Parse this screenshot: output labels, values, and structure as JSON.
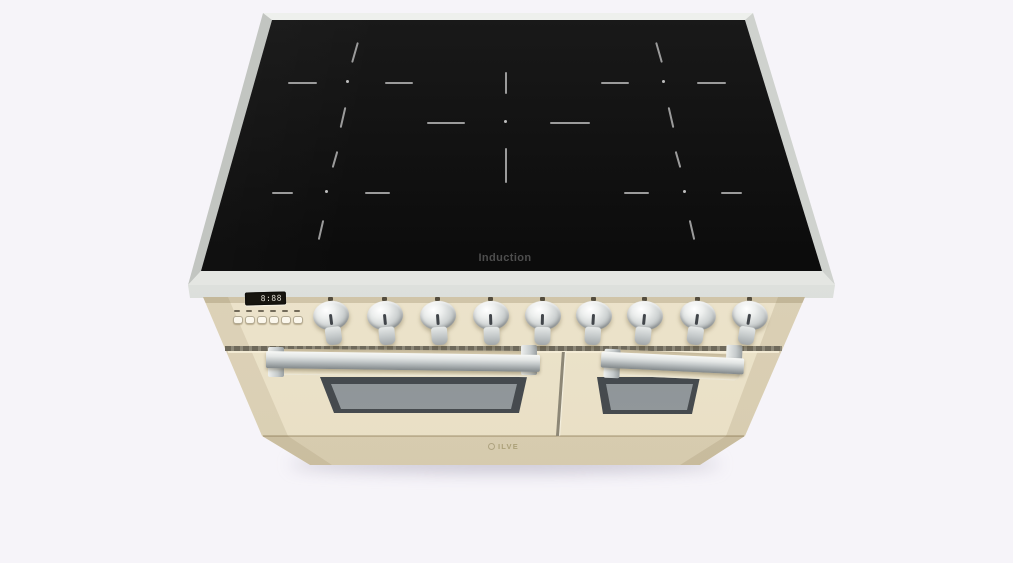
{
  "product": {
    "name": "Freestanding induction range cooker, top front view",
    "brand": "ILVE",
    "colors": {
      "background": "#f6f4f9",
      "body_cream": "#ece3cb",
      "cooktop_glass": "#0e0e0e",
      "stainless_trim": "#d6d9d5",
      "chrome_hardware": "#c3c8c9"
    }
  },
  "cooktop": {
    "label": "Induction",
    "zone_count": 5,
    "zones": [
      "back-left",
      "back-right",
      "center",
      "front-left",
      "front-right"
    ]
  },
  "control_panel": {
    "display": {
      "value": "8:88"
    },
    "button_count": 6,
    "knob_count": 9
  },
  "ovens": {
    "door_count": 2,
    "left_door": "large oven door with chrome handle and window",
    "right_door": "small oven door with chrome handle and window"
  },
  "branding": {
    "logo_text": "ILVE"
  }
}
